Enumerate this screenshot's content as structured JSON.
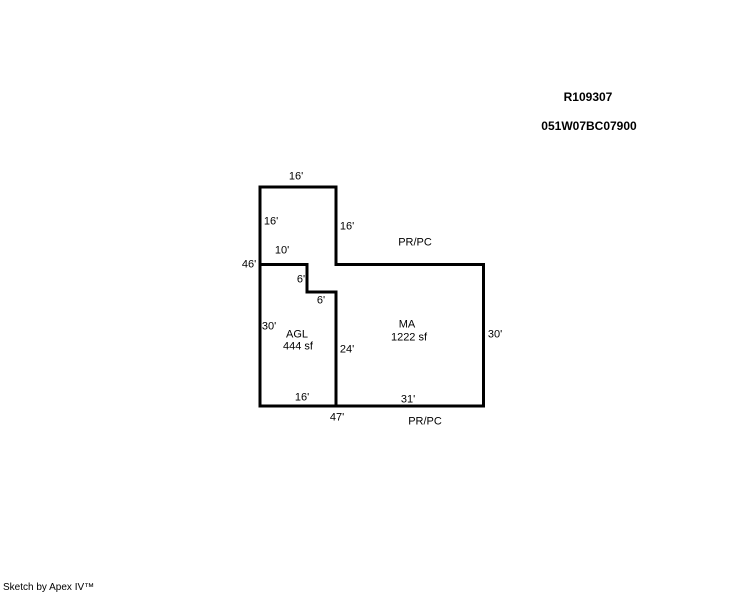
{
  "page": {
    "record_id": "R109307",
    "parcel_id": "051W07BC07900",
    "credit": "Sketch by Apex IV™"
  },
  "sketch": {
    "line_color": "#000000",
    "background_color": "#ffffff",
    "dims": {
      "top_16": "16'",
      "upper_left_16": "16'",
      "upper_right_16": "16'",
      "left_10": "10'",
      "left_46": "46'",
      "notch_6_vertical": "6'",
      "notch_6_horizontal": "6'",
      "agl_left_30": "30'",
      "divider_24": "24'",
      "ma_right_30": "30'",
      "bottom_left_16": "16'",
      "bottom_right_31": "31'",
      "bottom_total_47": "47'"
    },
    "areas": {
      "agl": {
        "code": "AGL",
        "size": "444 sf"
      },
      "ma": {
        "code": "MA",
        "size": "1222 sf"
      }
    },
    "annotations": {
      "prpc_top": "PR/PC",
      "prpc_bottom": "PR/PC"
    }
  }
}
